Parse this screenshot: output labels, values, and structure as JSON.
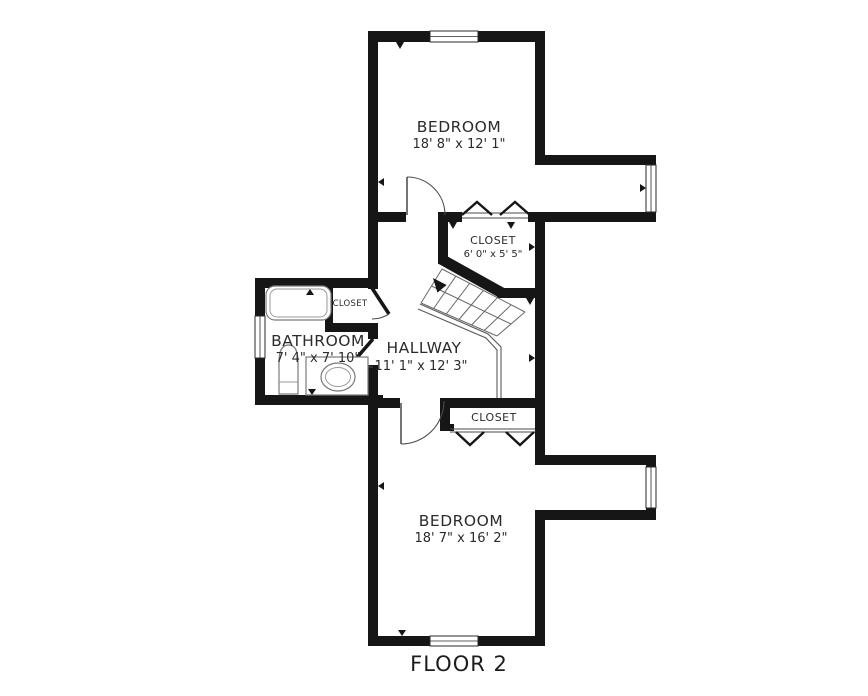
{
  "labels": {
    "bedroom_top": {
      "name": "BEDROOM",
      "dims": "18' 8\" x 12' 1\""
    },
    "closet_mid": {
      "name": "CLOSET",
      "dims": "6' 0\" x 5' 5\""
    },
    "bathroom": {
      "name": "BATHROOM",
      "dims": "7' 4\" x 7' 10\""
    },
    "hallway": {
      "name": "HALLWAY",
      "dims": "11' 1\" x 12' 3\""
    },
    "closet_bath": {
      "name": "CLOSET"
    },
    "closet_bottom": {
      "name": "CLOSET"
    },
    "bedroom_bottom": {
      "name": "BEDROOM",
      "dims": "18' 7\" x 16' 2\""
    },
    "floor": {
      "title": "FLOOR 2"
    }
  },
  "colors": {
    "wall": "#161616",
    "text": "#2b2b2b",
    "fixture_stroke": "#7a7a7a",
    "background": "#ffffff"
  },
  "icons": {
    "stairs_direction": "up-arrow-icon"
  }
}
